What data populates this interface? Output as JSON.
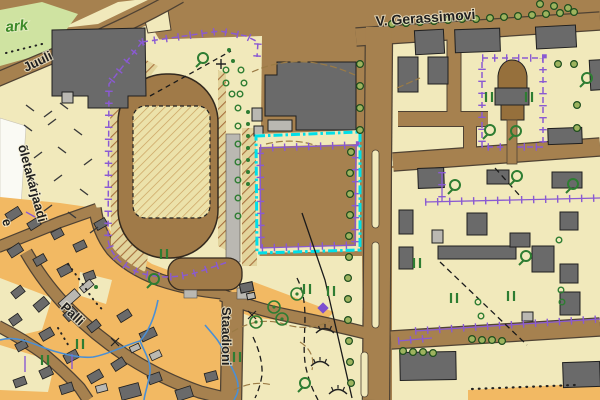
{
  "map": {
    "street_labels": {
      "gerassimovi": "V. Gerassimovi",
      "juuli": "Juuli",
      "palli": "Palli",
      "staadioni": "Staadioni",
      "left_street": "õletakarjaadi",
      "left_street_overflow": "e",
      "park_fragment": "ark"
    },
    "selection": {
      "description": "cyan dash-dot selection rectangle over fenced parcel",
      "color": "#00dfe8"
    },
    "palette": {
      "ground_brown": "#a6814f",
      "yard_beige": "#f1e9bb",
      "residential_orange": "#f2b963",
      "park_green": "#cfe3a1",
      "building_dark": "#6a6a6a",
      "building_light": "#bab8b2",
      "boundary_purple": "#8a5ad2",
      "water_blue": "#4b8fd4",
      "vegetation_green": "#2e7d32",
      "track_brown": "#a07a48"
    },
    "symbols": {
      "tree_row_circle": "#9db35e",
      "single_tree_circle_dot": "#2e7d32",
      "bush_pair_II": "#2e7d32",
      "scrub_Q": "#2e7d32",
      "embankment_arc": "#222222",
      "power_line": "#1a1a1a",
      "monument_diamond": "#7d4fd0"
    }
  }
}
